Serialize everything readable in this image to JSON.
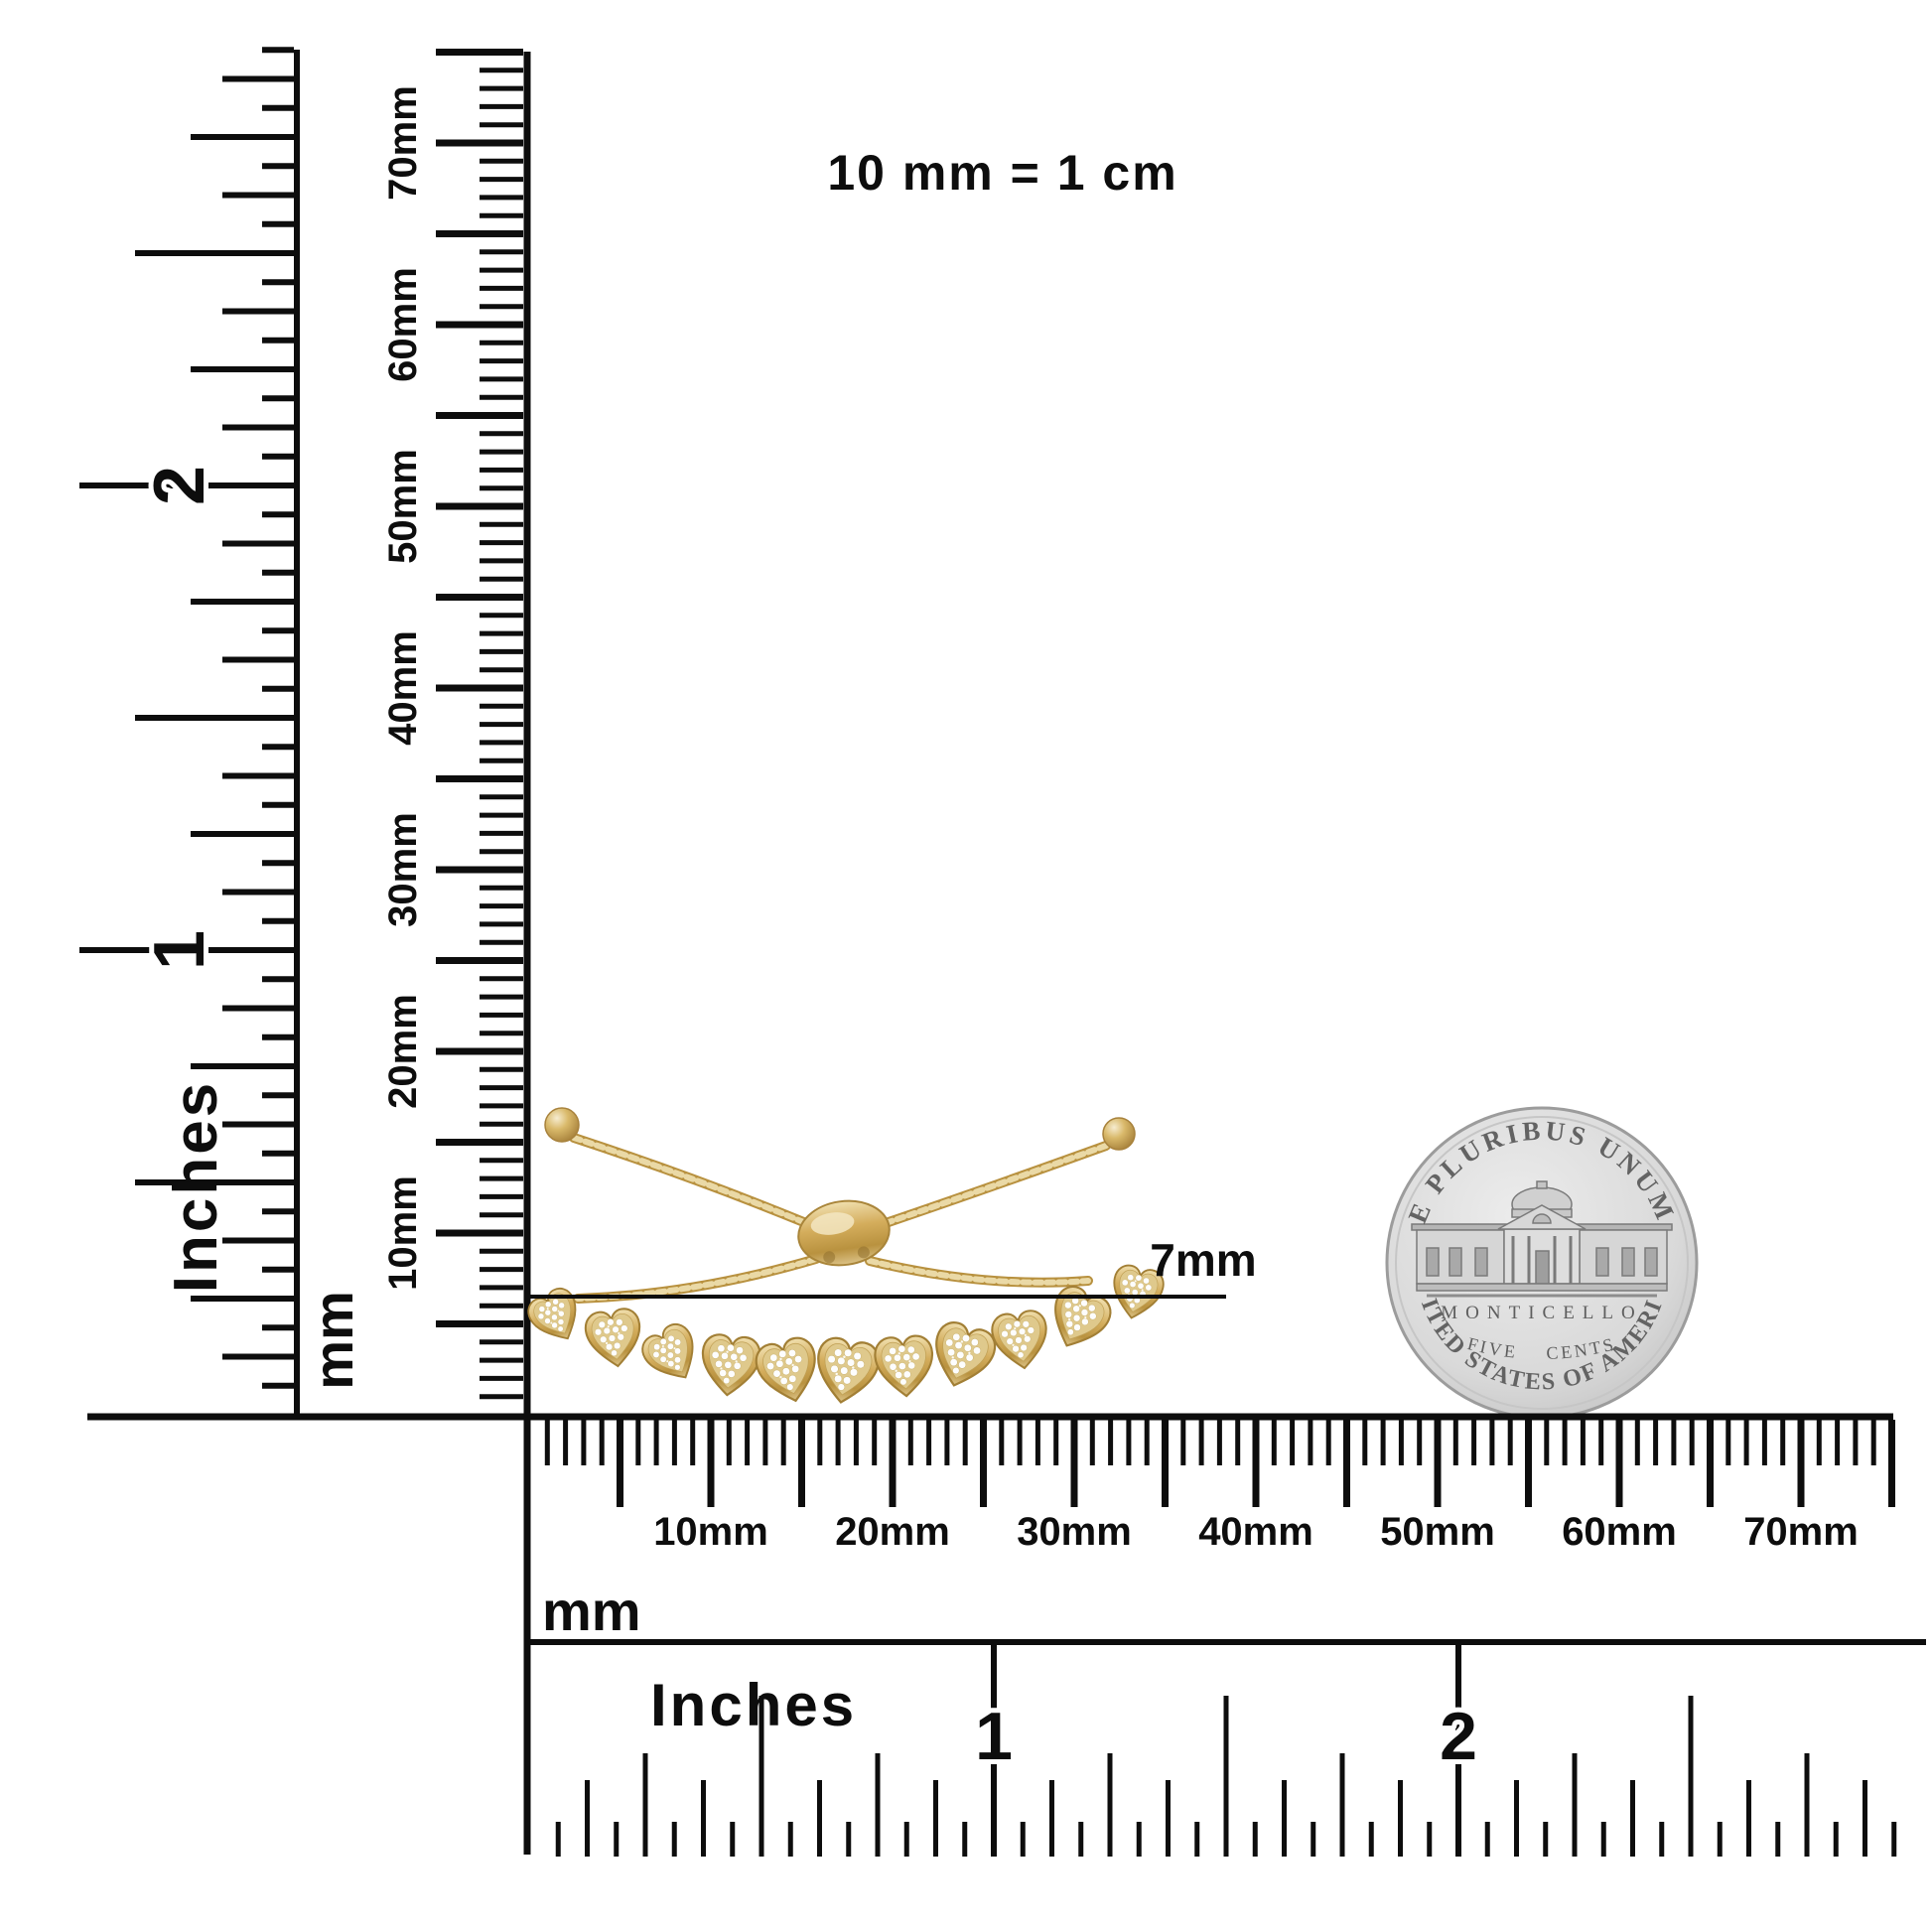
{
  "note": "10 mm = 1 cm",
  "measurement": {
    "label": "7mm"
  },
  "rulers": {
    "vertical_inches": {
      "unit": "Inches",
      "numbers": [
        "1",
        "2"
      ]
    },
    "vertical_mm": {
      "unit": "mm",
      "labels": [
        "10mm",
        "20mm",
        "30mm",
        "40mm",
        "50mm",
        "60mm",
        "70mm"
      ]
    },
    "horizontal_mm": {
      "unit": "mm",
      "labels": [
        "10mm",
        "20mm",
        "30mm",
        "40mm",
        "50mm",
        "60mm",
        "70mm"
      ]
    },
    "horizontal_inches": {
      "unit": "Inches",
      "numbers": [
        "1",
        "2"
      ]
    }
  },
  "coin": {
    "top_text": "E PLURIBUS UNUM",
    "building_name": "MONTICELLO",
    "denomination": "FIVE CENTS",
    "bottom_text": "UNITED STATES OF AMERICA"
  },
  "colors": {
    "ink": "#0d0d0d",
    "gold": "#c9a24e",
    "gold_light": "#f0dfae",
    "gold_dark": "#8f6f2e",
    "diamond": "#ffffff",
    "coin_silver": "#d9d9d9",
    "coin_detail": "#6e6e6e"
  }
}
